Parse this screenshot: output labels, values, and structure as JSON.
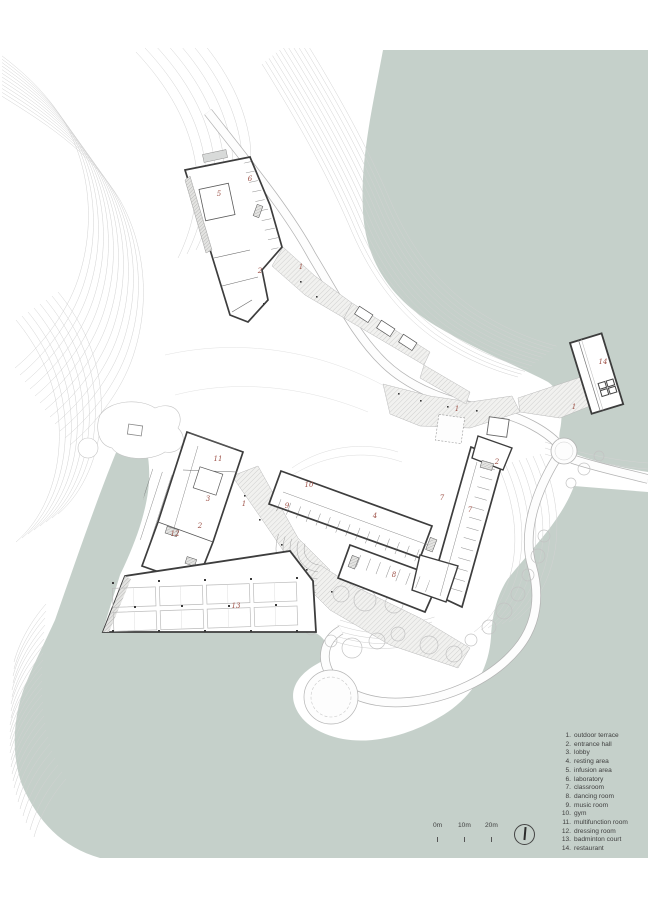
{
  "colors": {
    "water": "#c5d0ca",
    "room_label": "#9d5147",
    "wall": "#3d3d3d",
    "contour": "#d3d3d3"
  },
  "legend": {
    "items": [
      {
        "num": "1.",
        "label": "outdoor terrace"
      },
      {
        "num": "2.",
        "label": "entrance hall"
      },
      {
        "num": "3.",
        "label": "lobby"
      },
      {
        "num": "4.",
        "label": "resting area"
      },
      {
        "num": "5.",
        "label": "infusion area"
      },
      {
        "num": "6.",
        "label": "laboratory"
      },
      {
        "num": "7.",
        "label": "classroom"
      },
      {
        "num": "8.",
        "label": "dancing room"
      },
      {
        "num": "9.",
        "label": "music room"
      },
      {
        "num": "10.",
        "label": "gym"
      },
      {
        "num": "11.",
        "label": "multifunction room"
      },
      {
        "num": "12.",
        "label": "dressing room"
      },
      {
        "num": "13.",
        "label": "badminton court"
      },
      {
        "num": "14.",
        "label": "restaurant"
      }
    ]
  },
  "scale_bar": {
    "labels": [
      "0m",
      "10m",
      "20m"
    ]
  },
  "rooms": [
    {
      "n": "1",
      "x": 301,
      "y": 269
    },
    {
      "n": "1",
      "x": 244,
      "y": 506
    },
    {
      "n": "1",
      "x": 457,
      "y": 411
    },
    {
      "n": "1",
      "x": 574,
      "y": 409
    },
    {
      "n": "2",
      "x": 260,
      "y": 273
    },
    {
      "n": "2",
      "x": 497,
      "y": 464
    },
    {
      "n": "2",
      "x": 200,
      "y": 528
    },
    {
      "n": "3",
      "x": 208,
      "y": 501
    },
    {
      "n": "4",
      "x": 375,
      "y": 518
    },
    {
      "n": "5",
      "x": 219,
      "y": 196
    },
    {
      "n": "6",
      "x": 250,
      "y": 181
    },
    {
      "n": "7",
      "x": 442,
      "y": 500
    },
    {
      "n": "7",
      "x": 470,
      "y": 512
    },
    {
      "n": "8",
      "x": 394,
      "y": 577
    },
    {
      "n": "9",
      "x": 287,
      "y": 508
    },
    {
      "n": "10",
      "x": 309,
      "y": 487
    },
    {
      "n": "11",
      "x": 218,
      "y": 461
    },
    {
      "n": "12",
      "x": 175,
      "y": 536
    },
    {
      "n": "13",
      "x": 236,
      "y": 608
    },
    {
      "n": "14",
      "x": 603,
      "y": 364
    }
  ]
}
